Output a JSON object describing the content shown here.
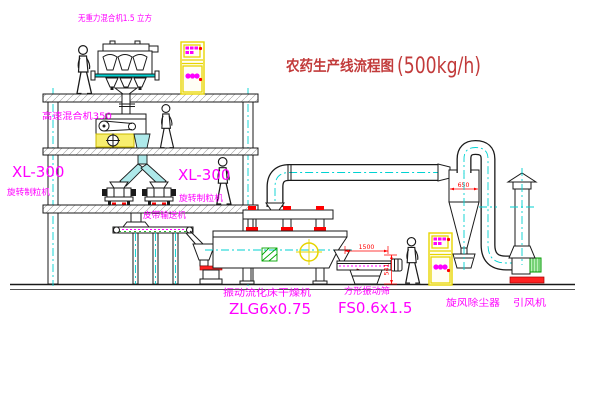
{
  "drawing": {
    "title": "农药生产线流程图",
    "title_capacity": "(500kg/h)",
    "labels": {
      "gravity_mixer": "无重力混合机1.5 立方",
      "high_speed_mixer": "高速混合机350",
      "granulator_model_left": "XL-300",
      "granulator_name_left": "旋转制粒机",
      "granulator_model_right": "XL-300",
      "granulator_name_right": "旋转制粒机",
      "belt_conveyor": "皮带输送机",
      "dryer_name": "振动流化床干燥机",
      "dryer_model": "ZLG6x0.75",
      "sieve_name": "方形振动筛",
      "sieve_model": "FS0.6x1.5",
      "cyclone_name": "旋风除尘器",
      "fan_name": "引风机"
    },
    "dimensions": {
      "cyclone_width": "650",
      "sieve_length": "1500",
      "sieve_height": "541"
    },
    "colors": {
      "label_magenta": "#ff00ff",
      "dimension_red": "#ff0000",
      "title_red": "#c23b3b",
      "centerline_cyan": "#00d2d2",
      "cabinet_yellow": "#e8d500",
      "line_black": "#1a1a1a",
      "background": "#ffffff"
    }
  }
}
